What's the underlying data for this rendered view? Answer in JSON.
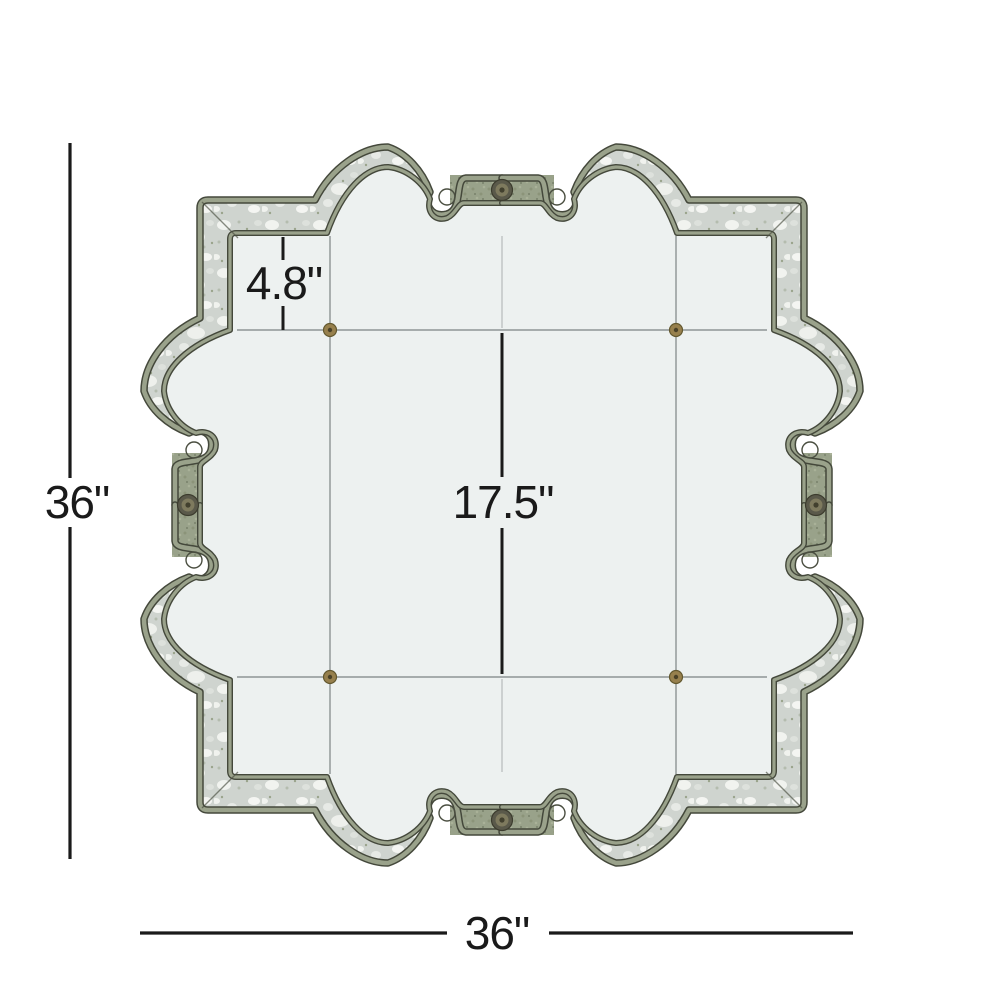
{
  "diagram": {
    "item_name": "antiqued-quatrefoil-wall-mirror-dimension-diagram",
    "labels": {
      "height": "36\"",
      "width": "36\"",
      "border_depth": "4.8\"",
      "center_panel": "17.5\""
    },
    "colors": {
      "background": "#ffffff",
      "dimension_ink": "#1a1a1a",
      "frame_sage": "#99a28a",
      "frame_outline": "#44483b",
      "antiqued_mirror_base": "#cfd4cf",
      "mirror_glass": "#edf1f0",
      "rosette_brass": "#97804d",
      "medallion_bronze": "#5a594a",
      "seam_gray": "#7d8484"
    }
  }
}
